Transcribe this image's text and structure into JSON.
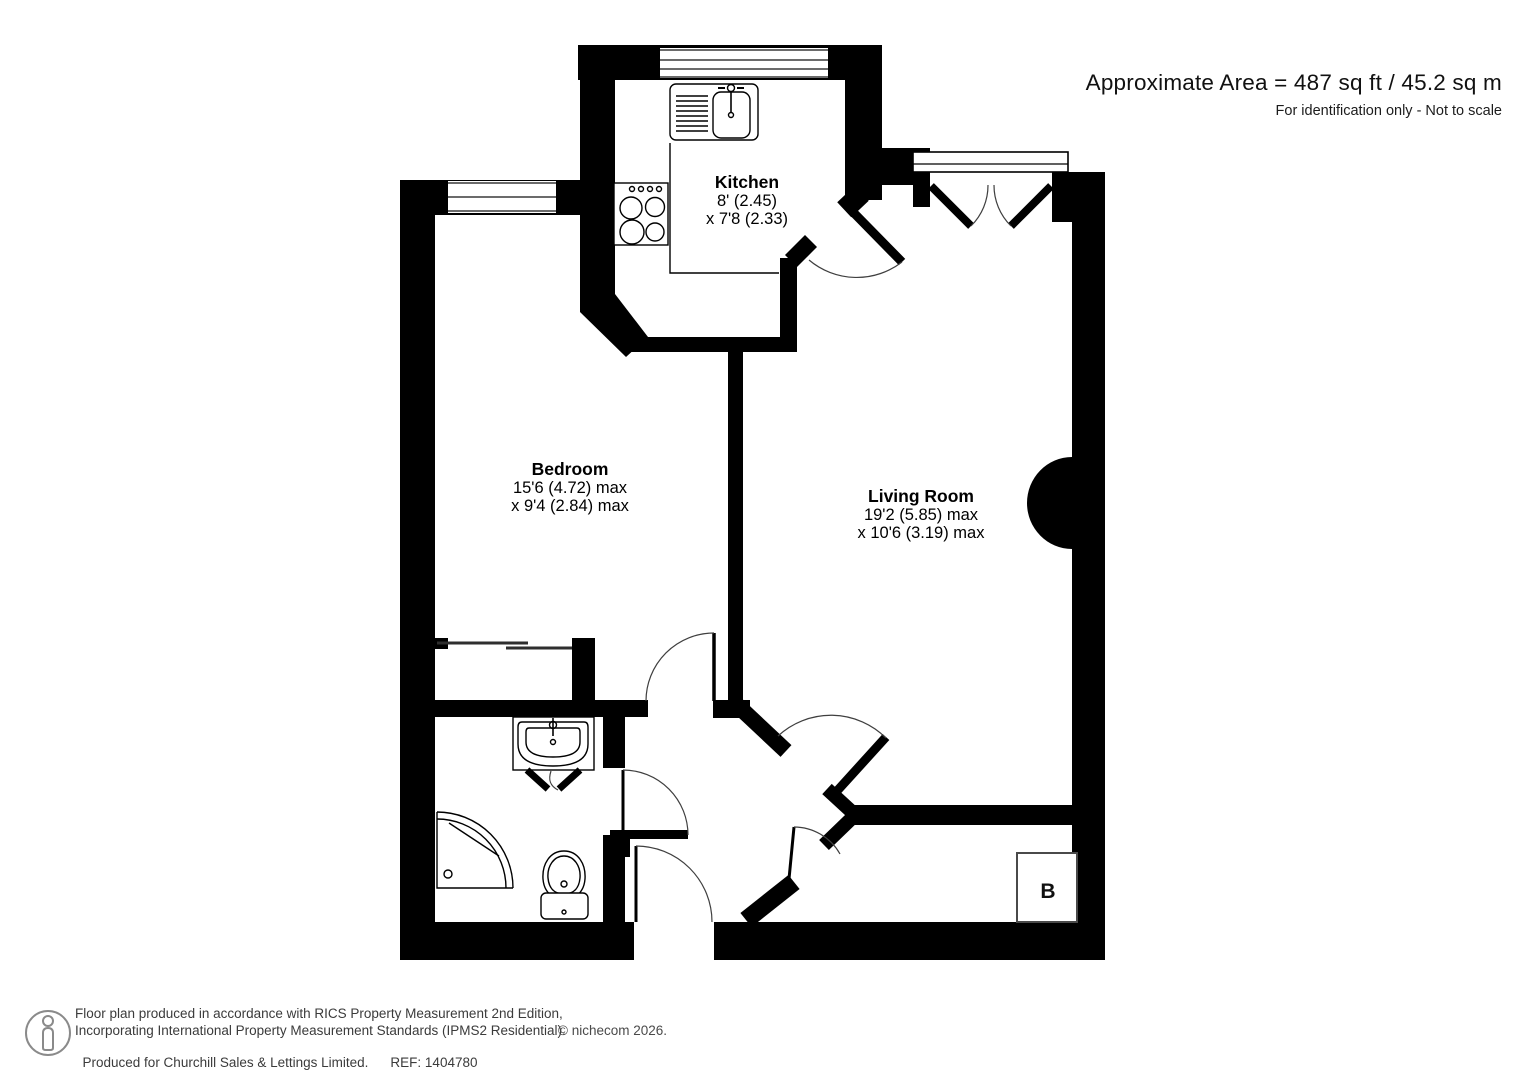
{
  "header": {
    "area_text": "Approximate Area = 487 sq ft / 45.2 sq m",
    "disclaimer": "For identification only - Not to scale"
  },
  "rooms": {
    "kitchen": {
      "name": "Kitchen",
      "dim_line1": "8' (2.45)",
      "dim_line2": "x 7'8 (2.33)"
    },
    "bedroom": {
      "name": "Bedroom",
      "dim_line1": "15'6 (4.72) max",
      "dim_line2": "x 9'4 (2.84) max"
    },
    "living_room": {
      "name": "Living Room",
      "dim_line1": "19'2 (5.85) max",
      "dim_line2": "x 10'6 (3.19) max"
    }
  },
  "labels": {
    "boiler": "B"
  },
  "footer": {
    "line1": "Floor plan produced in accordance with RICS Property Measurement 2nd Edition,",
    "line2": "Incorporating International Property Measurement Standards (IPMS2 Residential).",
    "line3": "Produced for Churchill Sales & Lettings Limited.",
    "ref": "REF: 1404780",
    "copyright": "© nichecom 2026."
  },
  "colors": {
    "wall": "#000000",
    "text": "#111111",
    "footer_text": "#3b3b3b",
    "logo_gray": "#8a8a8a"
  }
}
